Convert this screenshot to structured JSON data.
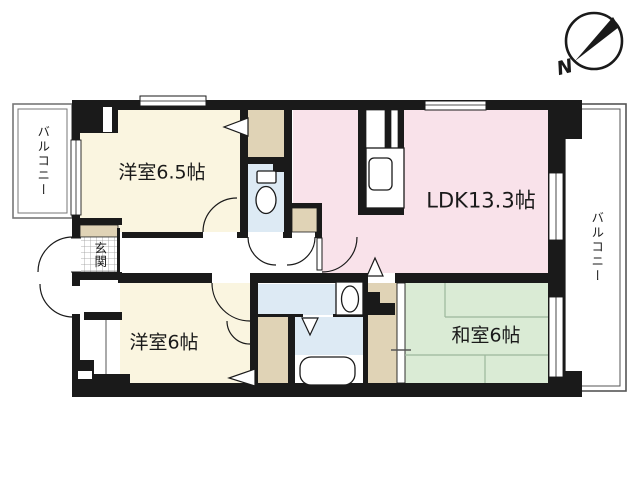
{
  "labels": {
    "room_west1": "洋室6.5帖",
    "ldk": "LDK13.3帖",
    "room_west2": "洋室6帖",
    "room_japanese": "和室6帖",
    "entrance": "玄関",
    "balcony_left": "バルコニー",
    "balcony_right": "バルコニー",
    "compass_north": "N"
  },
  "fixtures": {
    "icons": [
      "toilet-icon",
      "bathtub-icon",
      "washbasin-icon",
      "kitchen-sink-icon",
      "compass-icon",
      "entrance-tile-pattern"
    ]
  },
  "colors": {
    "wall": "#1a1a1a",
    "room_cream": "#FAF5E0",
    "ldk_pink": "#F9E2EA",
    "tatami_green": "#DAEBD5",
    "water_blue": "#DDEAF4",
    "closet_beige": "#E0D3B6",
    "tatami_line": "#9cb79c",
    "balcony_border": "#777777"
  }
}
